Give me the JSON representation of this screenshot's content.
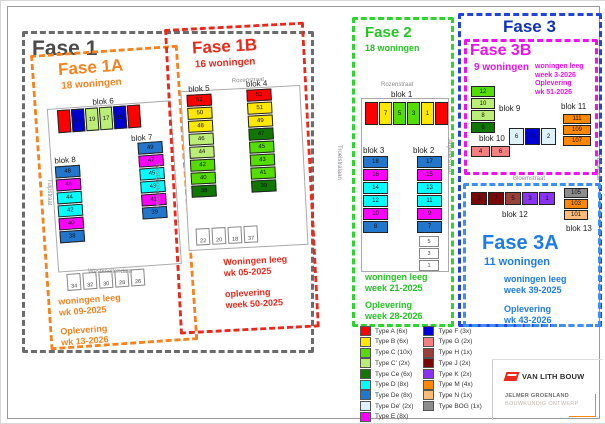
{
  "phases": {
    "fase1": {
      "title": "Fase 1"
    },
    "fase1a": {
      "title": "Fase 1A",
      "count": "18 woningen",
      "status": [
        "woningen leeg",
        "wk 09-2025",
        "Oplevering",
        "wk 13-2026"
      ]
    },
    "fase1b": {
      "title": "Fase 1B",
      "count": "16 woningen",
      "status": [
        "Woningen leeg",
        "wk 05-2025",
        "oplevering",
        "week 50-2025"
      ]
    },
    "fase2": {
      "title": "Fase 2",
      "count": "18 woningen",
      "status": [
        "woningen leeg",
        "week 21-2025",
        "Oplevering",
        "week 28-2026"
      ]
    },
    "fase3": {
      "title": "Fase 3"
    },
    "fase3b": {
      "title": "Fase 3B",
      "count": "9 woningen",
      "status": [
        "woningen leeg",
        "week 3-2026",
        "Oplevering",
        "wk 51-2026"
      ]
    },
    "fase3a": {
      "title": "Fase 3A",
      "count": "11 woningen",
      "status": [
        "woningen leeg",
        "week 39-2025",
        "Oplevering",
        "wk 43-2026"
      ]
    }
  },
  "colors": {
    "fase1": "#4a4a4a",
    "fase1a": "#f5821f",
    "fase1b": "#e8291c",
    "fase2": "#2dd42d",
    "fase3": "#1133bb",
    "fase3a": "#1e7be8",
    "fase3b": "#ee10ee"
  },
  "streets": {
    "rozenstraat1": "Rozenstraat",
    "rozenstraat2": "Rozenstraat",
    "tulpstraat": "Tulpstraat",
    "troelstralaan": "Troelstralaan",
    "anjelierstraat": "Anjelierstraat",
    "bloemstraat": "Bloemstraat",
    "zuideinde": "Zuideinde",
    "westknollendam_v": "Westknollendam",
    "westknollendam_h": "Westknollendam"
  },
  "blocks": {
    "blok1": {
      "label": "blok 1",
      "units": [
        {
          "n": "",
          "c": "#FF0000",
          "x": 1
        },
        {
          "n": "7",
          "c": "#FFE800"
        },
        {
          "n": "5",
          "c": "#55DD00"
        },
        {
          "n": "3",
          "c": "#55DD00"
        },
        {
          "n": "1",
          "c": "#FFE800"
        },
        {
          "n": "",
          "c": "#FF0000",
          "x": 1
        }
      ]
    },
    "blok2": {
      "label": "blok 2",
      "units": [
        {
          "n": "17",
          "c": "#2277CC",
          "x": 1
        },
        {
          "n": "15",
          "c": "#FF00FF",
          "x": 1
        },
        {
          "n": "13",
          "c": "#00FFFF"
        },
        {
          "n": "11",
          "c": "#00FFFF"
        },
        {
          "n": "9",
          "c": "#FF00FF",
          "x": 1
        },
        {
          "n": "7",
          "c": "#2277CC",
          "x": 1
        }
      ]
    },
    "blok3": {
      "label": "blok 3",
      "units": [
        {
          "n": "18",
          "c": "#2277CC",
          "x": 1
        },
        {
          "n": "16",
          "c": "#FF00FF",
          "x": 1
        },
        {
          "n": "14",
          "c": "#00FFFF"
        },
        {
          "n": "12",
          "c": "#00FFFF"
        },
        {
          "n": "10",
          "c": "#FF00FF",
          "x": 1
        },
        {
          "n": "8",
          "c": "#2277CC",
          "x": 1
        }
      ]
    },
    "blok4": {
      "label": "blok 4",
      "units": [
        {
          "n": "53",
          "c": "#FF0000",
          "x": 1
        },
        {
          "n": "51",
          "c": "#FFE800"
        },
        {
          "n": "49",
          "c": "#FFE800"
        },
        {
          "n": "47",
          "c": "#117700",
          "x": 1
        },
        {
          "n": "45",
          "c": "#55DD00"
        },
        {
          "n": "43",
          "c": "#55DD00"
        },
        {
          "n": "41",
          "c": "#55DD00"
        },
        {
          "n": "39",
          "c": "#117700",
          "x": 1
        }
      ]
    },
    "blok5": {
      "label": "blok 5",
      "units": [
        {
          "n": "52",
          "c": "#FF0000",
          "x": 1
        },
        {
          "n": "50",
          "c": "#FFE800"
        },
        {
          "n": "48",
          "c": "#FFE800"
        },
        {
          "n": "46",
          "c": "#BBEE77"
        },
        {
          "n": "44",
          "c": "#BBEE77"
        },
        {
          "n": "42",
          "c": "#55DD00"
        },
        {
          "n": "40",
          "c": "#55DD00"
        },
        {
          "n": "38",
          "c": "#117700",
          "x": 1
        }
      ]
    },
    "blok6": {
      "label": "blok 6",
      "units": [
        {
          "n": "",
          "c": "#FF0000",
          "x": 1
        },
        {
          "n": "21",
          "c": "#0000D0",
          "x": 1
        },
        {
          "n": "19",
          "c": "#BBEE77"
        },
        {
          "n": "17",
          "c": "#BBEE77"
        },
        {
          "n": "15",
          "c": "#0000D0",
          "x": 1
        },
        {
          "n": "",
          "c": "#FF0000",
          "x": 1
        }
      ]
    },
    "blok7": {
      "label": "blok 7",
      "units": [
        {
          "n": "49",
          "c": "#2277CC",
          "x": 1
        },
        {
          "n": "47",
          "c": "#FF00FF",
          "x": 1
        },
        {
          "n": "45",
          "c": "#00FFFF"
        },
        {
          "n": "43",
          "c": "#00FFFF"
        },
        {
          "n": "41",
          "c": "#FF00FF",
          "x": 1
        },
        {
          "n": "39",
          "c": "#2277CC",
          "x": 1
        }
      ]
    },
    "blok8": {
      "label": "blok 8",
      "units": [
        {
          "n": "48",
          "c": "#2277CC",
          "x": 1
        },
        {
          "n": "46",
          "c": "#FF00FF",
          "x": 1
        },
        {
          "n": "44",
          "c": "#00FFFF"
        },
        {
          "n": "42",
          "c": "#00FFFF"
        },
        {
          "n": "40",
          "c": "#FF00FF",
          "x": 1
        },
        {
          "n": "38",
          "c": "#2277CC",
          "x": 1
        }
      ]
    },
    "blok9": {
      "label": "blok 9",
      "units": [
        {
          "n": "12",
          "c": "#55DD00"
        },
        {
          "n": "10",
          "c": "#BBEE77"
        },
        {
          "n": "8",
          "c": "#BBEE77"
        },
        {
          "n": "6",
          "c": "#117700",
          "x": 1
        }
      ]
    },
    "blok10": {
      "label": "blok 10",
      "units": [
        {
          "n": "4",
          "c": "#F28080"
        },
        {
          "n": "6",
          "c": "#F28080",
          "x": 1
        }
      ]
    },
    "blok11": {
      "label": "blok 11",
      "units": [
        {
          "n": "111",
          "c": "#FF8800"
        },
        {
          "n": "109",
          "c": "#FF8800"
        },
        {
          "n": "107",
          "c": "#FF8800"
        }
      ]
    },
    "blok12": {
      "label": "blok 12",
      "units": [
        {
          "n": "9",
          "c": "#7A0A0A"
        },
        {
          "n": "7",
          "c": "#7A0A0A"
        },
        {
          "n": "5",
          "c": "#99403A"
        },
        {
          "n": "3",
          "c": "#8833EE",
          "x": 1
        },
        {
          "n": "1",
          "c": "#8833EE",
          "x": 1
        }
      ]
    },
    "blok13": {
      "label": "blok 13",
      "units": [
        {
          "n": "105",
          "c": "#8C8C8C"
        },
        {
          "n": "103",
          "c": "#FF8800"
        },
        {
          "n": "101",
          "c": "#FFBB77"
        }
      ]
    },
    "center3b": {
      "label": "",
      "units": [
        {
          "n": "6",
          "c": "#DDF2FB",
          "x": 1
        },
        {
          "n": "4",
          "c": "#0000D0"
        },
        {
          "n": "2",
          "c": "#DDF2FB",
          "x": 1
        }
      ]
    }
  },
  "lots": {
    "fase1a": [
      "34",
      "32",
      "30",
      "28",
      "26"
    ],
    "fase1b": [
      "22",
      "20",
      "18",
      "37"
    ],
    "fase2": [
      "5",
      "3",
      "1"
    ]
  },
  "legend": {
    "left": [
      {
        "label": "Type A (6x)",
        "color": "#FF0000"
      },
      {
        "label": "Type B (6x)",
        "color": "#FFE800"
      },
      {
        "label": "Type C (10x)",
        "color": "#55DD00"
      },
      {
        "label": "Type C' (2x)",
        "color": "#BBEE77"
      },
      {
        "label": "Type Ce (6x)",
        "color": "#117700"
      },
      {
        "label": "Type D (8x)",
        "color": "#00FFFF"
      },
      {
        "label": "Type De (8x)",
        "color": "#2277CC"
      },
      {
        "label": "Type De' (2x)",
        "color": "#DDF2FB"
      },
      {
        "label": "Type E (8x)",
        "color": "#FF00FF"
      }
    ],
    "right": [
      {
        "label": "Type F (3x)",
        "color": "#0000D0"
      },
      {
        "label": "Type G (2x)",
        "color": "#F28080"
      },
      {
        "label": "Type H (1x)",
        "color": "#99403A"
      },
      {
        "label": "Type J (2x)",
        "color": "#7A0A0A"
      },
      {
        "label": "Type K (2x)",
        "color": "#8833EE"
      },
      {
        "label": "Type M (4x)",
        "color": "#FF8800"
      },
      {
        "label": "Type N (1x)",
        "color": "#FFBB77"
      },
      {
        "label": "Type BOG (1x)",
        "color": "#8C8C8C"
      }
    ]
  },
  "titleblock": {
    "company": "VAN LITH BOUW",
    "name": "JELMER GROENLAND",
    "role": "BOUWKUNDIG ONTWERP"
  }
}
